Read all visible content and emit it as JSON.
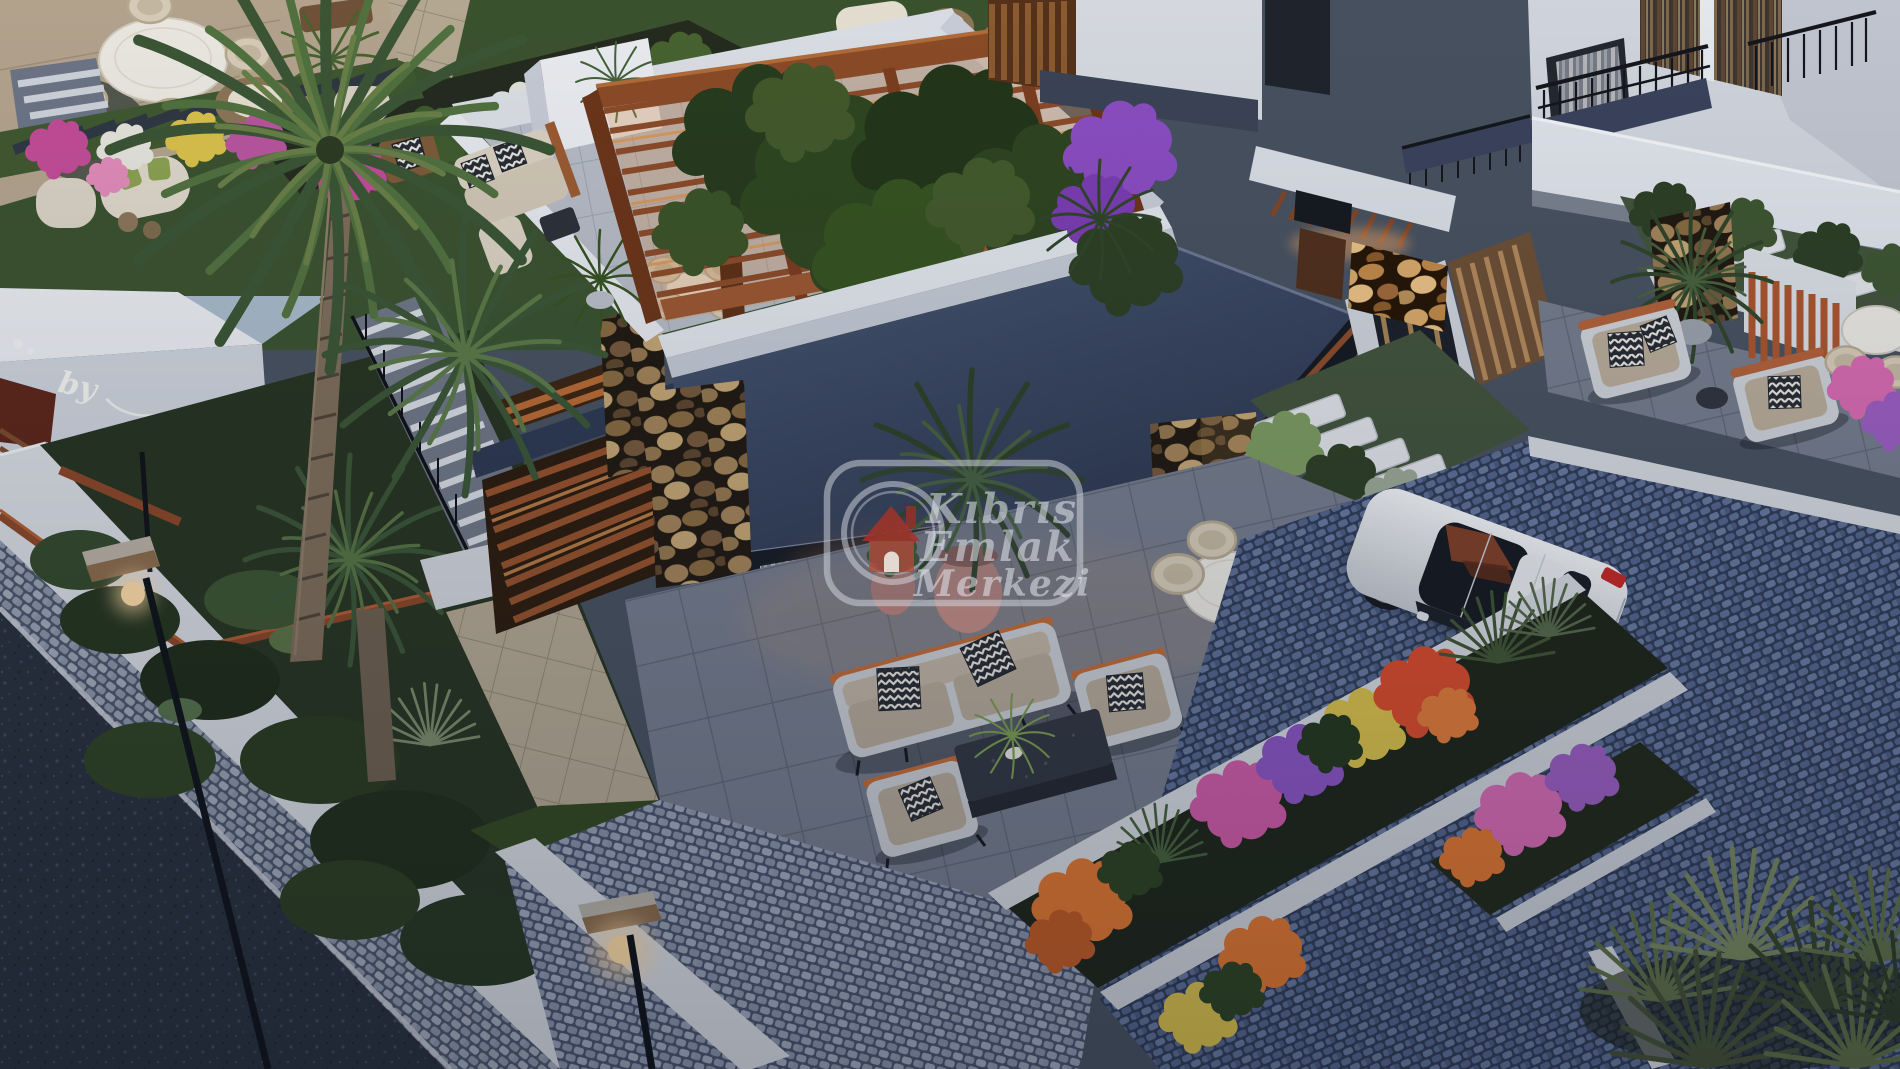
{
  "scene": {
    "type": "architectural-3d-render",
    "description": "Dusk aerial three-quarter view of a modern villa complex: flat dark slate roofs, rooftop pergola with vine canopy, stone-clad piers, landscaped gardens with flower planters, cobblestone driveway with parked white hatchback, street lamps glowing warm",
    "time_of_day": "dusk"
  },
  "watermark": {
    "badge_shape": "rounded-rectangle",
    "logo_icon": "house-in-circle-icon",
    "lines": [
      "Kıbrıs",
      "Emlak",
      "Merkezi"
    ],
    "house_color": "#a33228",
    "text_color": "rgba(228,231,236,0.55)"
  },
  "signage": {
    "wall_script_text": "by"
  },
  "palette": {
    "roof_slate": "#31405c",
    "wall_white": "#dfe2e7",
    "wood_warm": "#8a4a26",
    "pergola_glow": "#d8924e",
    "stone_tan": "#a28258",
    "cobble_blue": "#5d6e94",
    "cobble_light": "#98a0b0",
    "asphalt": "#272f3b",
    "grass": "#3a512e",
    "shrub_dark": "#24331c",
    "flower_magenta": "#c14b96",
    "flower_orange": "#e0762e",
    "flower_yellow": "#d9c04a",
    "flower_purple": "#8a54c2",
    "flower_red": "#d84a2a",
    "car_body": "#eef0f2",
    "taillight_red": "#c22824",
    "lamp_glow": "#ffd9a2",
    "cushion_taupe": "#b4a897",
    "chevron_dark": "#262a31"
  }
}
